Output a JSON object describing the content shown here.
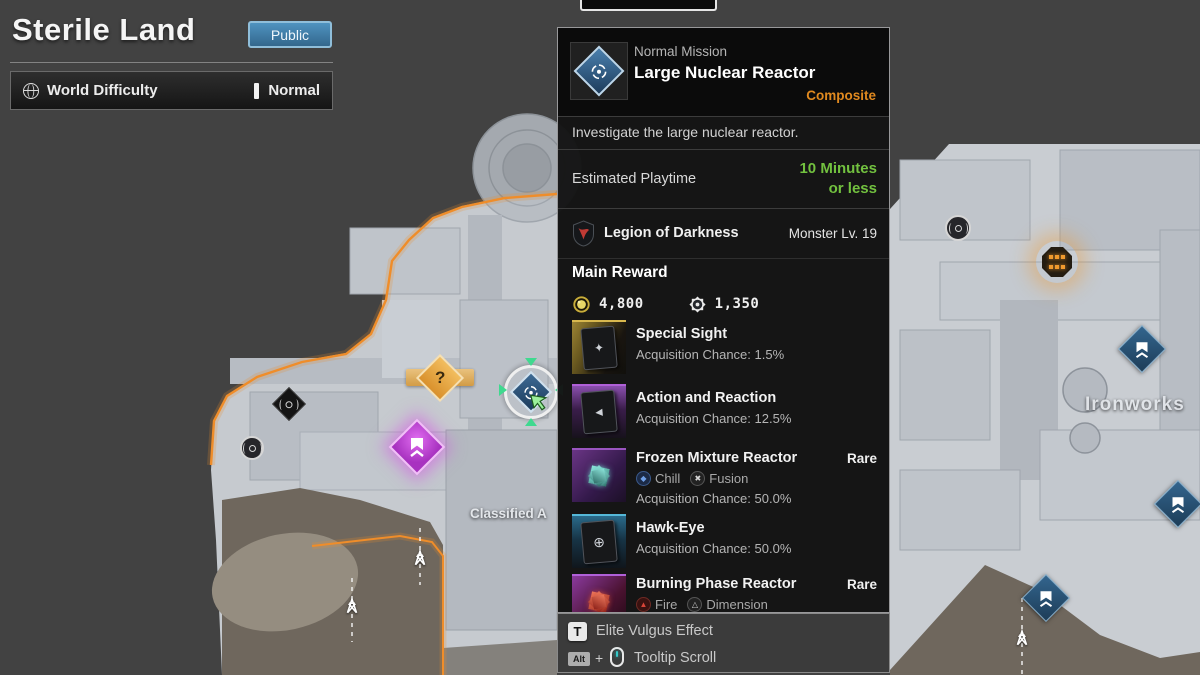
{
  "header": {
    "region_title": "Sterile Land",
    "public_label": "Public",
    "difficulty_label": "World Difficulty",
    "difficulty_value": "Normal"
  },
  "tooltip": {
    "type": "Normal Mission",
    "name": "Large Nuclear Reactor",
    "tag": "Composite",
    "description": "Investigate the large nuclear reactor.",
    "playtime_label": "Estimated Playtime",
    "playtime_line1": "10 Minutes",
    "playtime_line2": "or less",
    "faction": "Legion of Darkness",
    "monster_level": "Monster Lv. 19",
    "reward_title": "Main Reward",
    "currencies": [
      {
        "icon": "gold-coin-icon",
        "amount": "4,800"
      },
      {
        "icon": "kuiper-shard-icon",
        "amount": "1,350"
      }
    ],
    "rewards": [
      {
        "name": "Special Sight",
        "chance": "Acquisition Chance: 1.5%",
        "rarity": "",
        "tags": []
      },
      {
        "name": "Action and Reaction",
        "chance": "Acquisition Chance: 12.5%",
        "rarity": "",
        "tags": []
      },
      {
        "name": "Frozen Mixture Reactor",
        "chance": "Acquisition Chance: 50.0%",
        "rarity": "Rare",
        "tags": [
          "Chill",
          "Fusion"
        ]
      },
      {
        "name": "Hawk-Eye",
        "chance": "Acquisition Chance: 50.0%",
        "rarity": "",
        "tags": []
      },
      {
        "name": "Burning Phase Reactor",
        "chance": "",
        "rarity": "Rare",
        "tags": [
          "Fire",
          "Dimension"
        ]
      }
    ],
    "legend": {
      "key1": "T",
      "label1": "Elite Vulgus Effect",
      "key2": "Alt",
      "plus": "+",
      "label2": "Tooltip Scroll"
    }
  },
  "map": {
    "q_marker": "?",
    "labels": {
      "classified": "Classified A",
      "ironworks": "Ironworks"
    }
  },
  "colors": {
    "map_edge_orange": "#ef8d2a",
    "playtime_green": "#72c13f",
    "composite_orange": "#e0891f",
    "public_blue": "#4f93c0",
    "purple_marker": "#c84fd8",
    "selection_green": "#3fd98f"
  }
}
